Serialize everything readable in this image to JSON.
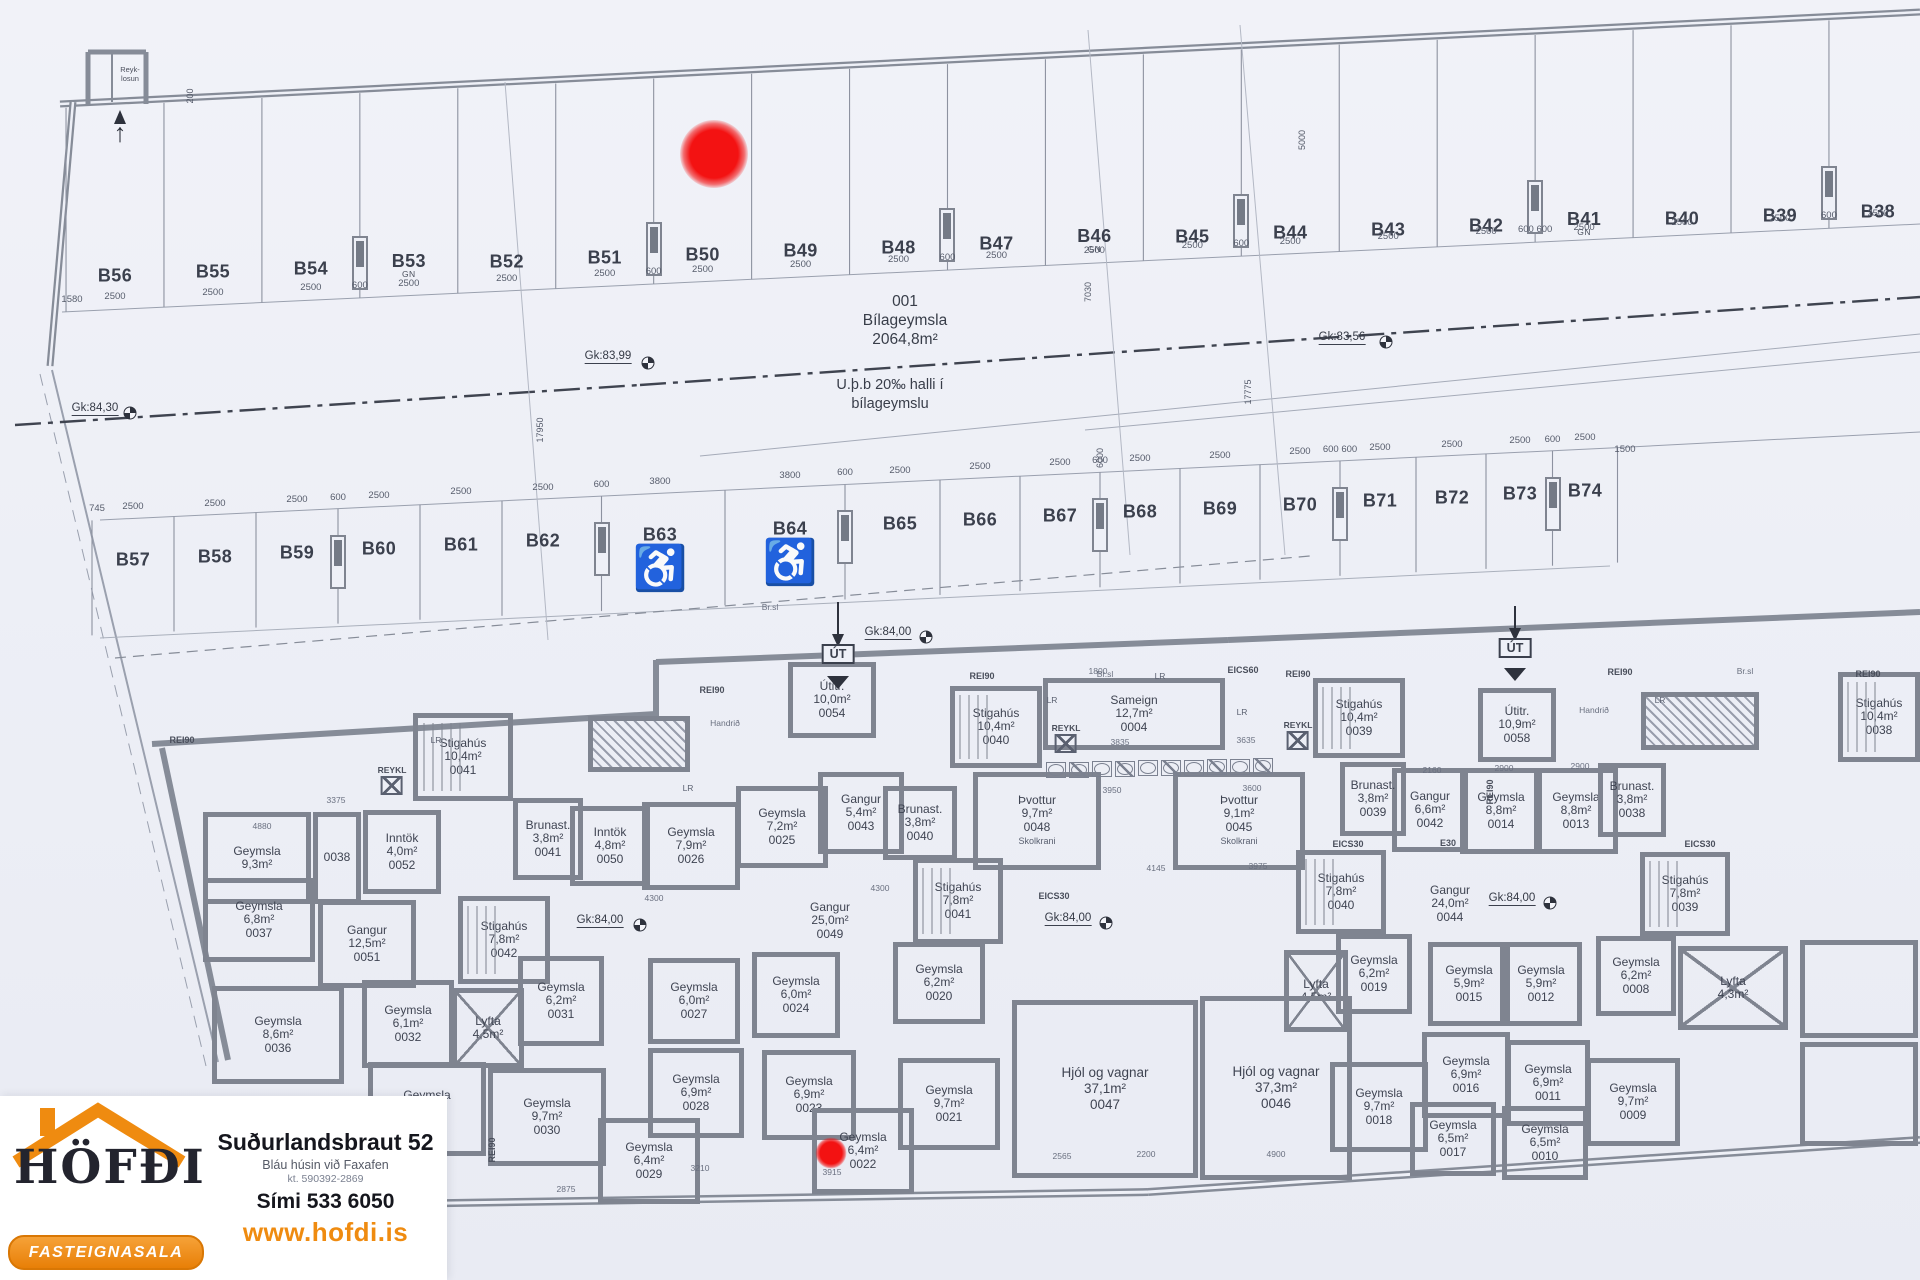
{
  "colors": {
    "wall": "#7f8490",
    "line": "#9aa0ae",
    "ink": "#3b404d",
    "accent": "#ef8b10",
    "red": "#f31212"
  },
  "garage": {
    "area_id": "001",
    "area_name": "Bílageymsla",
    "area_size": "2064,8m²",
    "slope_note_1": "U.þ.b 20‰ halli í",
    "slope_note_2": "bílageymslu",
    "chimney_1": "Reyk-",
    "chimney_2": "losun",
    "exit_label": "ÚT",
    "levels": [
      {
        "t": "Gk:84,30",
        "x": 95,
        "y": 409,
        "mx": 130,
        "my": 413
      },
      {
        "t": "Gk:83,99",
        "x": 608,
        "y": 357,
        "mx": 648,
        "my": 363
      },
      {
        "t": "Gk:83,56",
        "x": 1342,
        "y": 338,
        "mx": 1386,
        "my": 342
      },
      {
        "t": "Gk:84,00",
        "x": 888,
        "y": 633,
        "mx": 926,
        "my": 637
      },
      {
        "t": "Gk:84,00",
        "x": 600,
        "y": 921,
        "mx": 640,
        "my": 925
      },
      {
        "t": "Gk:84,00",
        "x": 1068,
        "y": 919,
        "mx": 1106,
        "my": 923
      },
      {
        "t": "Gk:84,00",
        "x": 1512,
        "y": 899,
        "mx": 1550,
        "my": 903
      }
    ]
  },
  "parking": {
    "top_row": {
      "extra_left_dim": "1580",
      "stalls": [
        {
          "id": "B56",
          "dim": "2500"
        },
        {
          "id": "B55",
          "dim": "2500"
        },
        {
          "id": "B54",
          "dim": "2500"
        },
        {
          "id": "B53",
          "dim": "2500",
          "tag": "GN"
        },
        {
          "id": "B52",
          "dim": "2500"
        },
        {
          "id": "B51",
          "dim": "2500"
        },
        {
          "id": "B50",
          "dim": "2500"
        },
        {
          "id": "B49",
          "dim": "2500"
        },
        {
          "id": "B48",
          "dim": "2500"
        },
        {
          "id": "B47",
          "dim": "2500"
        },
        {
          "id": "B46",
          "dim": "2500",
          "tag": "GN"
        },
        {
          "id": "B45",
          "dim": "2500"
        },
        {
          "id": "B44",
          "dim": "2500"
        },
        {
          "id": "B43",
          "dim": "2500"
        },
        {
          "id": "B42",
          "dim": "2500"
        },
        {
          "id": "B41",
          "dim": "2500",
          "tag": "GN"
        },
        {
          "id": "B40",
          "dim": "2500"
        },
        {
          "id": "B39",
          "dim": "2500"
        },
        {
          "id": "B38",
          "dim": "2500"
        }
      ],
      "columns": [
        {
          "boundary": 3,
          "label": "600"
        },
        {
          "boundary": 6,
          "label": "600"
        },
        {
          "boundary": 9,
          "label": "600"
        },
        {
          "boundary": 12,
          "label": "600"
        },
        {
          "boundary": 15,
          "label": "600 600"
        },
        {
          "boundary": 18,
          "label": "600"
        }
      ]
    },
    "mid_row": {
      "extra_left_dim": "745",
      "extra_right_dim": "1500",
      "stalls": [
        {
          "id": "B57",
          "dim": "2500"
        },
        {
          "id": "B58",
          "dim": "2500"
        },
        {
          "id": "B59",
          "dim": "2500"
        },
        {
          "id": "B60",
          "dim": "2500"
        },
        {
          "id": "B61",
          "dim": "2500"
        },
        {
          "id": "B62",
          "dim": "2500"
        },
        {
          "id": "B63",
          "dim": "3800",
          "handicap": true
        },
        {
          "id": "B64",
          "dim": "3800",
          "handicap": true
        },
        {
          "id": "B65",
          "dim": "2500"
        },
        {
          "id": "B66",
          "dim": "2500"
        },
        {
          "id": "B67",
          "dim": "2500"
        },
        {
          "id": "B68",
          "dim": "2500"
        },
        {
          "id": "B69",
          "dim": "2500"
        },
        {
          "id": "B70",
          "dim": "2500"
        },
        {
          "id": "B71",
          "dim": "2500"
        },
        {
          "id": "B72",
          "dim": "2500"
        },
        {
          "id": "B73",
          "dim": "2500"
        },
        {
          "id": "B74",
          "dim": "2500"
        }
      ],
      "columns": [
        {
          "boundary": 3,
          "label": "600"
        },
        {
          "boundary": 6,
          "label": "600"
        },
        {
          "boundary": 8,
          "label": "600"
        },
        {
          "boundary": 11,
          "label": "600"
        },
        {
          "boundary": 14,
          "label": "600 600"
        },
        {
          "boundary": 17,
          "label": "600"
        }
      ]
    }
  },
  "rooms": [
    {
      "n": "Stigahús",
      "a": "10,4m²",
      "num": "0041",
      "x": 413,
      "y": 713,
      "w": 100,
      "h": 88,
      "cls": "stair"
    },
    {
      "n": "Geymsla",
      "a": "9,3m²",
      "num": "",
      "x": 203,
      "y": 812,
      "w": 108,
      "h": 92
    },
    {
      "n": "",
      "a": "",
      "num": "0038",
      "x": 313,
      "y": 812,
      "w": 48,
      "h": 92
    },
    {
      "n": "Inntök",
      "a": "4,0m²",
      "num": "0052",
      "x": 363,
      "y": 810,
      "w": 78,
      "h": 84
    },
    {
      "n": "Brunast.",
      "a": "3,8m²",
      "num": "0041",
      "x": 513,
      "y": 798,
      "w": 70,
      "h": 82
    },
    {
      "n": "Geymsla",
      "a": "6,8m²",
      "num": "0037",
      "x": 203,
      "y": 878,
      "w": 112,
      "h": 84
    },
    {
      "n": "Gangur",
      "a": "12,5m²",
      "num": "0051",
      "x": 318,
      "y": 900,
      "w": 98,
      "h": 88
    },
    {
      "n": "Stigahús",
      "a": "7,8m²",
      "num": "0042",
      "x": 458,
      "y": 896,
      "w": 92,
      "h": 88,
      "cls": "stair"
    },
    {
      "n": "Geymsla",
      "a": "8,6m²",
      "num": "0036",
      "x": 212,
      "y": 986,
      "w": 132,
      "h": 98
    },
    {
      "n": "Geymsla",
      "a": "6,1m²",
      "num": "0032",
      "x": 362,
      "y": 980,
      "w": 92,
      "h": 88
    },
    {
      "n": "Lyfta",
      "a": "4,5m²",
      "num": "",
      "x": 452,
      "y": 988,
      "w": 72,
      "h": 80,
      "cls": "lift"
    },
    {
      "n": "Geymsla",
      "a": "6,2m²",
      "num": "0031",
      "x": 518,
      "y": 956,
      "w": 86,
      "h": 90
    },
    {
      "n": "Geymsla",
      "a": "9,7m²",
      "num": "0033",
      "x": 368,
      "y": 1062,
      "w": 118,
      "h": 94
    },
    {
      "n": "Geymsla",
      "a": "9,7m²",
      "num": "0030",
      "x": 488,
      "y": 1068,
      "w": 118,
      "h": 98
    },
    {
      "n": "Geymsla",
      "a": "6,4m²",
      "num": "0029",
      "x": 598,
      "y": 1118,
      "w": 102,
      "h": 86
    },
    {
      "n": "Geymsla",
      "a": "6,0m²",
      "num": "0027",
      "x": 648,
      "y": 958,
      "w": 92,
      "h": 86
    },
    {
      "n": "Geymsla",
      "a": "6,9m²",
      "num": "0028",
      "x": 648,
      "y": 1048,
      "w": 96,
      "h": 90
    },
    {
      "n": "Geymsla",
      "a": "6,0m²",
      "num": "0024",
      "x": 752,
      "y": 952,
      "w": 88,
      "h": 86
    },
    {
      "n": "Geymsla",
      "a": "6,9m²",
      "num": "0023",
      "x": 762,
      "y": 1050,
      "w": 94,
      "h": 90
    },
    {
      "n": "Geymsla",
      "a": "6,4m²",
      "num": "0022",
      "x": 812,
      "y": 1108,
      "w": 102,
      "h": 86
    },
    {
      "n": "Geymsla",
      "a": "9,7m²",
      "num": "0021",
      "x": 898,
      "y": 1058,
      "w": 102,
      "h": 92
    },
    {
      "n": "Geymsla",
      "a": "6,2m²",
      "num": "0020",
      "x": 893,
      "y": 942,
      "w": 92,
      "h": 82
    },
    {
      "n": "Geymsla",
      "a": "7,9m²",
      "num": "0026",
      "x": 642,
      "y": 802,
      "w": 98,
      "h": 88
    },
    {
      "n": "Geymsla",
      "a": "7,2m²",
      "num": "0025",
      "x": 736,
      "y": 786,
      "w": 92,
      "h": 82
    },
    {
      "n": "Gangur",
      "a": "5,4m²",
      "num": "0043",
      "x": 818,
      "y": 772,
      "w": 86,
      "h": 82
    },
    {
      "n": "Inntök",
      "a": "4,8m²",
      "num": "0050",
      "x": 570,
      "y": 806,
      "w": 80,
      "h": 80
    },
    {
      "n": "Stigahús",
      "a": "7,8m²",
      "num": "0041",
      "x": 913,
      "y": 858,
      "w": 90,
      "h": 86,
      "cls": "stair"
    },
    {
      "n": "Brunast.",
      "a": "3,8m²",
      "num": "0040",
      "x": 883,
      "y": 786,
      "w": 74,
      "h": 74
    },
    {
      "n": "Útitr.",
      "a": "10,0m²",
      "num": "0054",
      "x": 788,
      "y": 662,
      "w": 88,
      "h": 76
    },
    {
      "n": "Sameign",
      "a": "12,7m²",
      "num": "0004",
      "x": 1043,
      "y": 678,
      "w": 182,
      "h": 72
    },
    {
      "n": "Stigahús",
      "a": "10,4m²",
      "num": "0040",
      "x": 950,
      "y": 686,
      "w": 92,
      "h": 82,
      "cls": "stair"
    },
    {
      "n": "Þvottur",
      "a": "9,7m²",
      "num": "0048",
      "sub": "Skolkrani",
      "x": 973,
      "y": 772,
      "w": 128,
      "h": 98
    },
    {
      "n": "Þvottur",
      "a": "9,1m²",
      "num": "0045",
      "sub": "Skolkrani",
      "x": 1173,
      "y": 772,
      "w": 132,
      "h": 98
    },
    {
      "n": "Stigahús",
      "a": "10,4m²",
      "num": "0039",
      "x": 1313,
      "y": 678,
      "w": 92,
      "h": 80,
      "cls": "stair"
    },
    {
      "n": "Gangur",
      "a": "6,6m²",
      "num": "0042",
      "x": 1392,
      "y": 768,
      "w": 76,
      "h": 84
    },
    {
      "n": "Geymsla",
      "a": "8,8m²",
      "num": "0014",
      "x": 1460,
      "y": 768,
      "w": 82,
      "h": 86
    },
    {
      "n": "Geymsla",
      "a": "8,8m²",
      "num": "0013",
      "x": 1534,
      "y": 768,
      "w": 84,
      "h": 86
    },
    {
      "n": "Brunast.",
      "a": "3,8m²",
      "num": "0039",
      "x": 1340,
      "y": 762,
      "w": 66,
      "h": 74
    },
    {
      "n": "Brunast.",
      "a": "3,8m²",
      "num": "0038",
      "x": 1598,
      "y": 763,
      "w": 68,
      "h": 74
    },
    {
      "n": "Stigahús",
      "a": "7,8m²",
      "num": "0040",
      "x": 1296,
      "y": 850,
      "w": 90,
      "h": 84,
      "cls": "stair"
    },
    {
      "n": "Stigahús",
      "a": "7,8m²",
      "num": "0039",
      "x": 1640,
      "y": 852,
      "w": 90,
      "h": 84,
      "cls": "stair"
    },
    {
      "n": "Geymsla",
      "a": "6,2m²",
      "num": "0019",
      "x": 1336,
      "y": 934,
      "w": 76,
      "h": 80
    },
    {
      "n": "Lyfta",
      "a": "4,5m²",
      "num": "",
      "x": 1284,
      "y": 950,
      "w": 64,
      "h": 82,
      "cls": "lift"
    },
    {
      "n": "Geymsla",
      "a": "5,9m²",
      "num": "0015",
      "x": 1428,
      "y": 942,
      "w": 82,
      "h": 84
    },
    {
      "n": "Geymsla",
      "a": "5,9m²",
      "num": "0012",
      "x": 1500,
      "y": 942,
      "w": 82,
      "h": 84
    },
    {
      "n": "Geymsla",
      "a": "6,2m²",
      "num": "0008",
      "x": 1596,
      "y": 936,
      "w": 80,
      "h": 80
    },
    {
      "n": "Lyfta",
      "a": "4,3m²",
      "num": "",
      "x": 1678,
      "y": 946,
      "w": 110,
      "h": 84,
      "cls": "lift"
    },
    {
      "n": "Geymsla",
      "a": "6,9m²",
      "num": "0016",
      "x": 1422,
      "y": 1032,
      "w": 88,
      "h": 86
    },
    {
      "n": "Geymsla",
      "a": "6,9m²",
      "num": "0011",
      "x": 1506,
      "y": 1040,
      "w": 84,
      "h": 86
    },
    {
      "n": "Geymsla",
      "a": "9,7m²",
      "num": "0018",
      "x": 1330,
      "y": 1062,
      "w": 98,
      "h": 90
    },
    {
      "n": "Geymsla",
      "a": "9,7m²",
      "num": "0009",
      "x": 1586,
      "y": 1058,
      "w": 94,
      "h": 88
    },
    {
      "n": "Geymsla",
      "a": "6,5m²",
      "num": "0017",
      "x": 1410,
      "y": 1102,
      "w": 86,
      "h": 74
    },
    {
      "n": "Geymsla",
      "a": "6,5m²",
      "num": "0010",
      "x": 1502,
      "y": 1106,
      "w": 86,
      "h": 74
    },
    {
      "n": "Hjól og vagnar",
      "a": "37,1m²",
      "num": "0047",
      "x": 1012,
      "y": 1000,
      "w": 186,
      "h": 178,
      "cls": "big"
    },
    {
      "n": "Hjól og vagnar",
      "a": "37,3m²",
      "num": "0046",
      "x": 1200,
      "y": 996,
      "w": 152,
      "h": 184,
      "cls": "big"
    },
    {
      "n": "Útitr.",
      "a": "10,9m²",
      "num": "0058",
      "x": 1478,
      "y": 688,
      "w": 78,
      "h": 74
    },
    {
      "n": "Stigahús",
      "a": "10,4m²",
      "num": "0038",
      "x": 1838,
      "y": 672,
      "w": 82,
      "h": 90,
      "cls": "stair"
    },
    {
      "n": "Gangur",
      "a": "25,0m²",
      "num": "0049",
      "x": 770,
      "y": 888,
      "w": 120,
      "h": 66,
      "cls": "nobox"
    },
    {
      "n": "Gangur",
      "a": "24,0m²",
      "num": "0044",
      "x": 1392,
      "y": 872,
      "w": 116,
      "h": 64,
      "cls": "nobox"
    },
    {
      "n": "",
      "a": "",
      "num": "",
      "x": 1800,
      "y": 940,
      "w": 118,
      "h": 98
    },
    {
      "n": "",
      "a": "",
      "num": "",
      "x": 1800,
      "y": 1042,
      "w": 118,
      "h": 104
    }
  ],
  "hatches": [
    {
      "x": 588,
      "y": 716,
      "w": 102,
      "h": 56
    },
    {
      "x": 1641,
      "y": 692,
      "w": 118,
      "h": 58
    }
  ],
  "annotations": {
    "reykl_label": "REYKL",
    "reykl": [
      {
        "x": 392,
        "y": 780
      },
      {
        "x": 1066,
        "y": 738
      },
      {
        "x": 1298,
        "y": 735
      }
    ],
    "handrail": [
      {
        "t": "Handrið",
        "x": 725,
        "y": 723
      },
      {
        "t": "Handrið",
        "x": 1594,
        "y": 710
      }
    ],
    "brsl": [
      {
        "t": "Br.sl",
        "x": 770,
        "y": 607
      },
      {
        "t": "Br.sl",
        "x": 1105,
        "y": 674
      },
      {
        "t": "Br.sl",
        "x": 1745,
        "y": 671
      }
    ],
    "lr": [
      {
        "x": 436,
        "y": 740
      },
      {
        "x": 688,
        "y": 788
      },
      {
        "x": 1052,
        "y": 700
      },
      {
        "x": 1242,
        "y": 712
      },
      {
        "x": 1660,
        "y": 700
      },
      {
        "x": 1160,
        "y": 676
      }
    ],
    "walltags": [
      {
        "t": "REI90",
        "x": 182,
        "y": 740
      },
      {
        "t": "REI90",
        "x": 712,
        "y": 690
      },
      {
        "t": "REI90",
        "x": 982,
        "y": 676
      },
      {
        "t": "REI90",
        "x": 1298,
        "y": 674
      },
      {
        "t": "REI90",
        "x": 1620,
        "y": 672
      },
      {
        "t": "REI90",
        "x": 1868,
        "y": 674
      },
      {
        "t": "EICS60",
        "x": 1243,
        "y": 670
      },
      {
        "t": "EICS30",
        "x": 1348,
        "y": 844
      },
      {
        "t": "EICS30",
        "x": 1054,
        "y": 896
      },
      {
        "t": "EICS30",
        "x": 1700,
        "y": 844
      },
      {
        "t": "E30",
        "x": 1448,
        "y": 843
      },
      {
        "t": "REI90",
        "x": 492,
        "y": 1150,
        "v": true
      },
      {
        "t": "REI90",
        "x": 1490,
        "y": 792,
        "v": true
      }
    ],
    "tinydims": [
      {
        "t": "4880",
        "x": 262,
        "y": 826
      },
      {
        "t": "3375",
        "x": 336,
        "y": 800
      },
      {
        "t": "4300",
        "x": 654,
        "y": 898
      },
      {
        "t": "4300",
        "x": 880,
        "y": 888
      },
      {
        "t": "1800",
        "x": 1098,
        "y": 671
      },
      {
        "t": "3835",
        "x": 1120,
        "y": 742
      },
      {
        "t": "3635",
        "x": 1246,
        "y": 740
      },
      {
        "t": "3950",
        "x": 1112,
        "y": 790
      },
      {
        "t": "3600",
        "x": 1252,
        "y": 788
      },
      {
        "t": "4145",
        "x": 1156,
        "y": 868
      },
      {
        "t": "3975",
        "x": 1258,
        "y": 866
      },
      {
        "t": "2160",
        "x": 1432,
        "y": 770
      },
      {
        "t": "2900",
        "x": 1504,
        "y": 768
      },
      {
        "t": "2900",
        "x": 1580,
        "y": 766
      },
      {
        "t": "3210",
        "x": 700,
        "y": 1168
      },
      {
        "t": "3915",
        "x": 832,
        "y": 1172
      },
      {
        "t": "2875",
        "x": 566,
        "y": 1189
      },
      {
        "t": "2565",
        "x": 1062,
        "y": 1156
      },
      {
        "t": "2200",
        "x": 1146,
        "y": 1154
      },
      {
        "t": "4900",
        "x": 1276,
        "y": 1154
      }
    ],
    "vdims": [
      {
        "t": "200",
        "x": 190,
        "y": 96
      },
      {
        "t": "5000",
        "x": 1302,
        "y": 140
      },
      {
        "t": "7030",
        "x": 1088,
        "y": 292
      },
      {
        "t": "17950",
        "x": 540,
        "y": 430
      },
      {
        "t": "6000",
        "x": 1100,
        "y": 458
      },
      {
        "t": "17775",
        "x": 1248,
        "y": 392
      }
    ]
  },
  "red_markers": [
    {
      "x": 714,
      "y": 154,
      "d": 68
    },
    {
      "x": 831,
      "y": 1153,
      "d": 31
    }
  ],
  "logo": {
    "brand": "HÖFÐI",
    "banner": "FASTEIGNASALA",
    "address": "Suðurlandsbraut 52",
    "address_sub": "Bláu húsin við Faxafen",
    "reg": "kt. 590392-2869",
    "phone": "Sími 533 6050",
    "web": "www.hofdi.is"
  }
}
